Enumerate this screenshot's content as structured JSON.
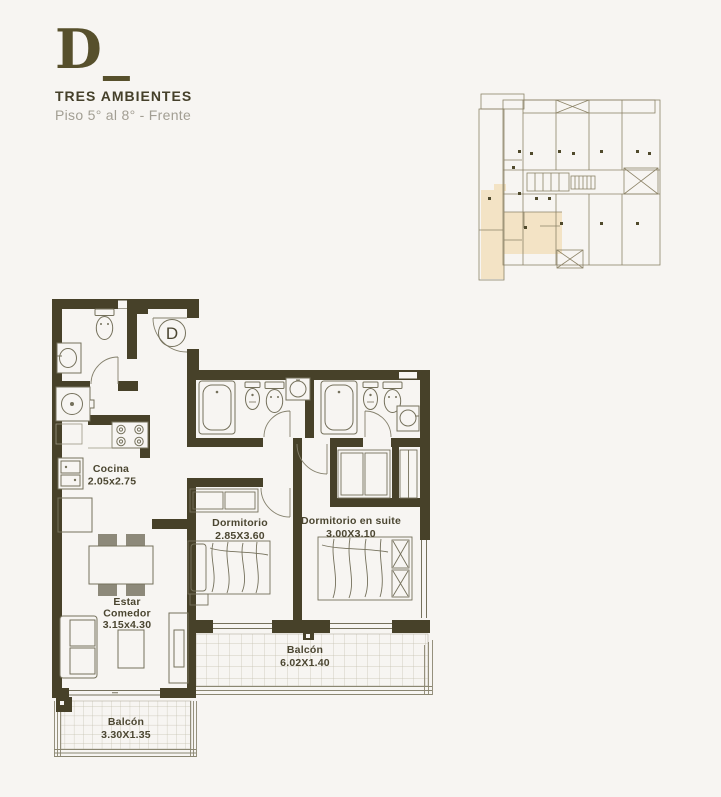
{
  "header": {
    "letter": "D_",
    "title": "TRES AMBIENTES",
    "subtitle": "Piso 5° al 8° - Frente"
  },
  "unit_badge": "D",
  "rooms": {
    "cocina": {
      "name": "Cocina",
      "dims": "2.05x2.75"
    },
    "estar": {
      "line1": "Estar",
      "line2": "Comedor",
      "dims": "3.15x4.30"
    },
    "dormitorio": {
      "name": "Dormitorio",
      "dims": "2.85X3.60"
    },
    "suite": {
      "name": "Dormitorio en suite",
      "dims": "3.00X3.10"
    },
    "balcon_grande": {
      "name": "Balcón",
      "dims": "6.02X1.40"
    },
    "balcon_chico": {
      "name": "Balcón",
      "dims": "3.30X1.35"
    }
  },
  "colors": {
    "background": "#f7f5f2",
    "wall": "#474129",
    "fixture_line": "#75715c",
    "tile_line": "#c3bfae",
    "railing_line": "#8a8671",
    "label_text": "#4b4631",
    "title_text": "#45402a",
    "subtitle_text": "#a29e93",
    "keyplan_line": "#8d8468",
    "keyplan_highlight": "#f3e3c5"
  }
}
